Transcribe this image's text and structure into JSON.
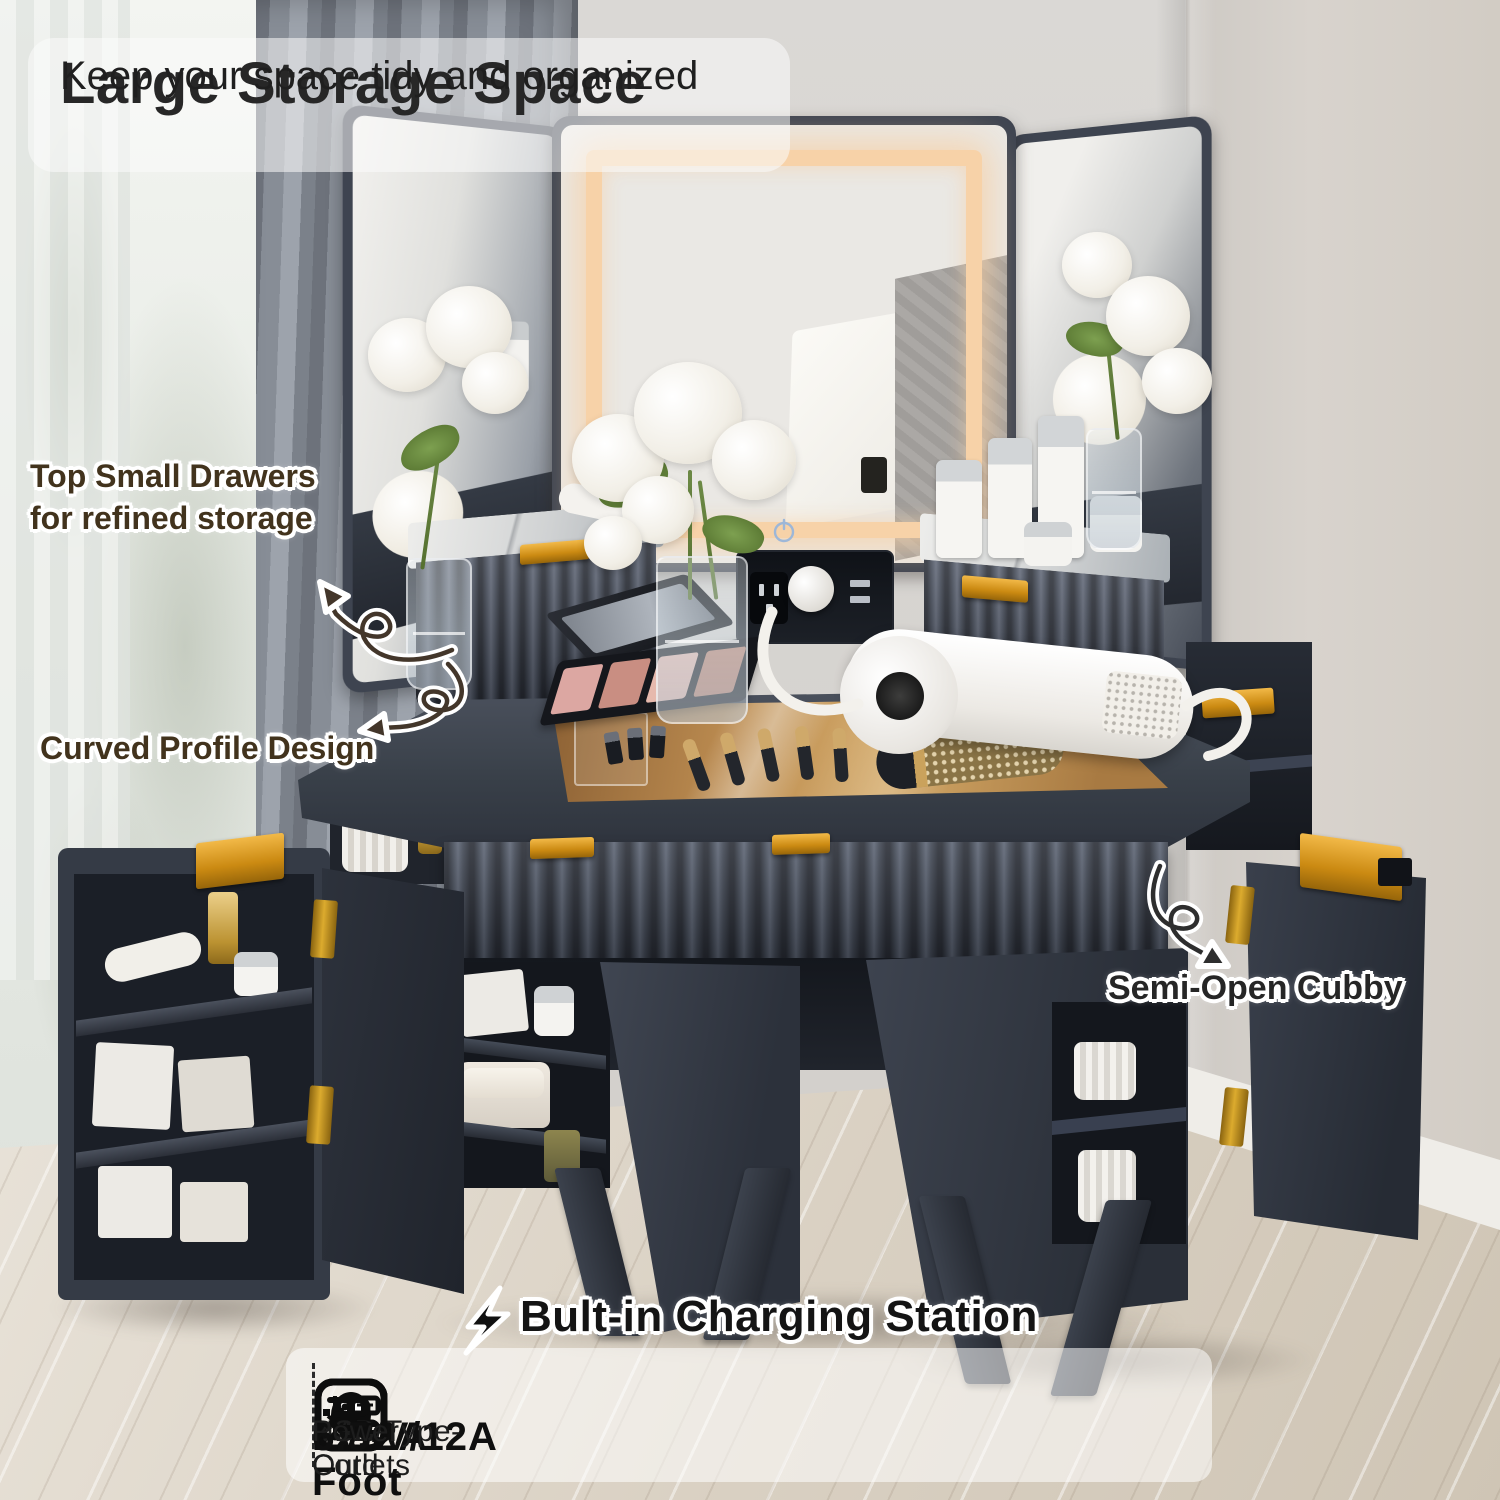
{
  "header": {
    "title": "Large Storage Space",
    "subtitle": "Keep your space tidy and organized"
  },
  "callouts": {
    "top_drawers_line1": "Top Small Drawers",
    "top_drawers_line2": "for refined storage",
    "curved_profile": "Curved Profile Design",
    "semi_open_cubby": "Semi-Open Cubby"
  },
  "charging": {
    "title": "Bult-in Charging Station",
    "specs": [
      {
        "icon": "ac-outlet-icon",
        "value": "125V/12A",
        "label": "2 AC Outlets"
      },
      {
        "icon": "usb-icon",
        "value": "5V/2A",
        "label": "USB/Type-C"
      },
      {
        "icon": "power-cord-icon",
        "value": "6.5-Foot",
        "label": "Power Cord"
      }
    ]
  },
  "colors": {
    "cabinet": "#3a4150",
    "gold_hardware": "#d3961f",
    "led_glow": "#f7d2a8",
    "wall": "#d8d6d3",
    "floor_wood": "#d8cfc2"
  }
}
